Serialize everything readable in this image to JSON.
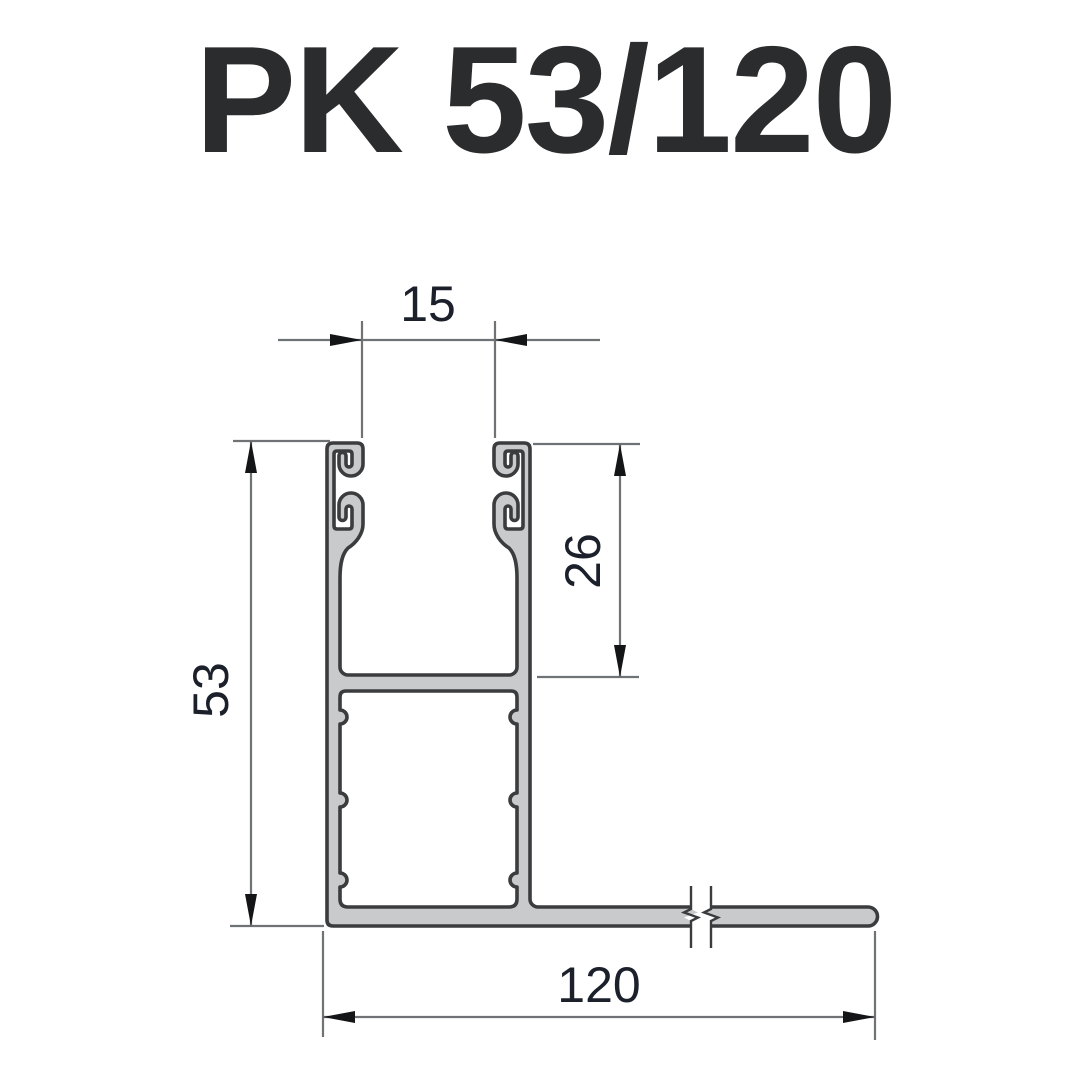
{
  "title": "PK 53/120",
  "drawing": {
    "type": "aluminium-profile-cross-section",
    "dimensions": {
      "slot_width": {
        "value": "15",
        "location": "top",
        "unit_note": "between guide hook faces"
      },
      "channel_depth": {
        "value": "26",
        "location": "right",
        "unit_note": "upper channel depth"
      },
      "profile_height": {
        "value": "53",
        "location": "left",
        "unit_note": "overall height"
      },
      "base_width": {
        "value": "120",
        "location": "bottom",
        "unit_note": "overall base leg width"
      }
    },
    "colors": {
      "profile_fill": "#c9cacc",
      "profile_outline": "#3b3c3e",
      "dimension_line": "#6f7376",
      "arrow": "#131517",
      "dimension_text": "#1b202b",
      "title_text": "#2b2c2e",
      "background": "#ffffff"
    }
  }
}
